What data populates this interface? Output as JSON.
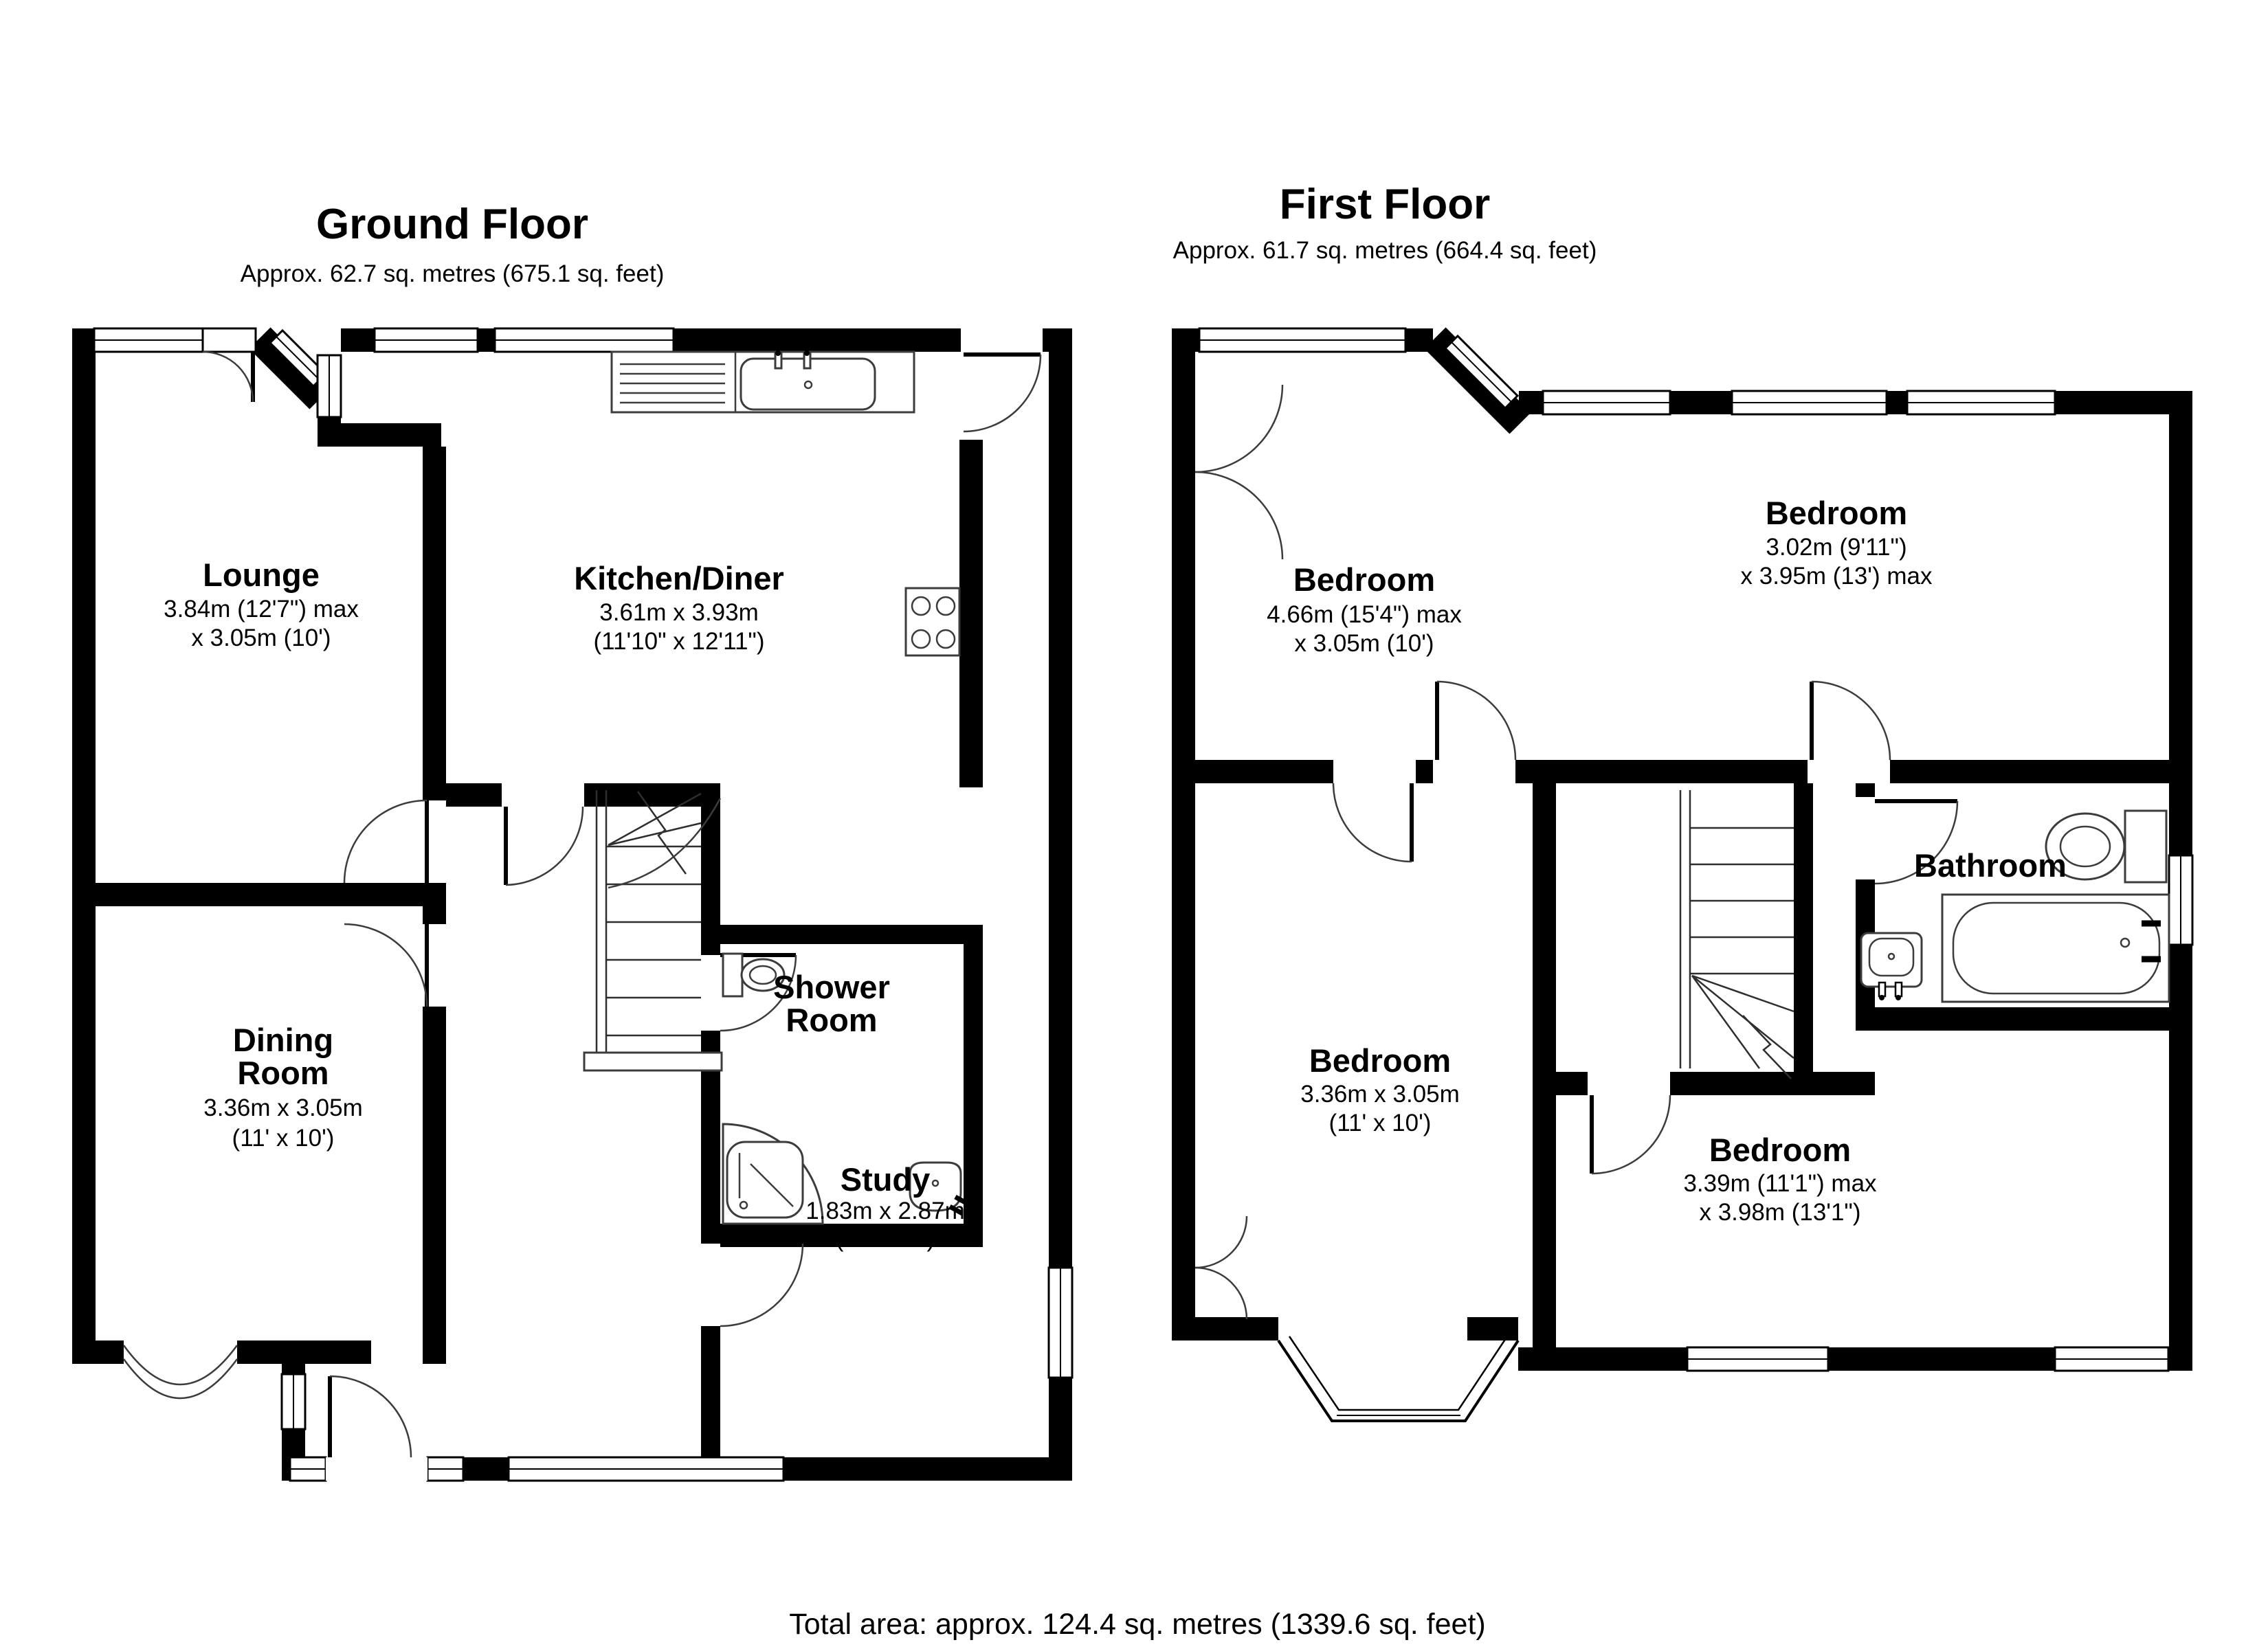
{
  "ground_floor": {
    "title": "Ground Floor",
    "subtitle": "Approx. 62.7 sq. metres (675.1 sq. feet)",
    "rooms": {
      "lounge": {
        "name": "Lounge",
        "dim1": "3.84m (12'7\") max",
        "dim2": "x 3.05m (10')"
      },
      "kitchen": {
        "name": "Kitchen/Diner",
        "dim1": "3.61m x 3.93m",
        "dim2": "(11'10\" x 12'11\")"
      },
      "dining": {
        "name": "Dining",
        "name2": "Room",
        "dim1": "3.36m x 3.05m",
        "dim2": "(11' x 10')"
      },
      "shower": {
        "name": "Shower",
        "name2": "Room"
      },
      "study": {
        "name": "Study",
        "dim1": "1.83m x 2.87m",
        "dim2": "(6' x 9'5\")"
      }
    }
  },
  "first_floor": {
    "title": "First Floor",
    "subtitle": "Approx. 61.7 sq. metres (664.4 sq. feet)",
    "rooms": {
      "bedroom1": {
        "name": "Bedroom",
        "dim1": "4.66m (15'4\") max",
        "dim2": "x 3.05m (10')"
      },
      "bedroom2": {
        "name": "Bedroom",
        "dim1": "3.02m (9'11\")",
        "dim2": "x 3.95m (13') max"
      },
      "bedroom3": {
        "name": "Bedroom",
        "dim1": "3.36m x 3.05m",
        "dim2": "(11' x 10')"
      },
      "bedroom4": {
        "name": "Bedroom",
        "dim1": "3.39m (11'1\") max",
        "dim2": "x 3.98m (13'1\")"
      },
      "bathroom": {
        "name": "Bathroom"
      }
    }
  },
  "footer": {
    "total_area": "Total area: approx. 124.4 sq. metres (1339.6 sq. feet)"
  },
  "colors": {
    "wall": "#000000",
    "background": "#ffffff",
    "fixture_line": "#3c3c3c"
  }
}
